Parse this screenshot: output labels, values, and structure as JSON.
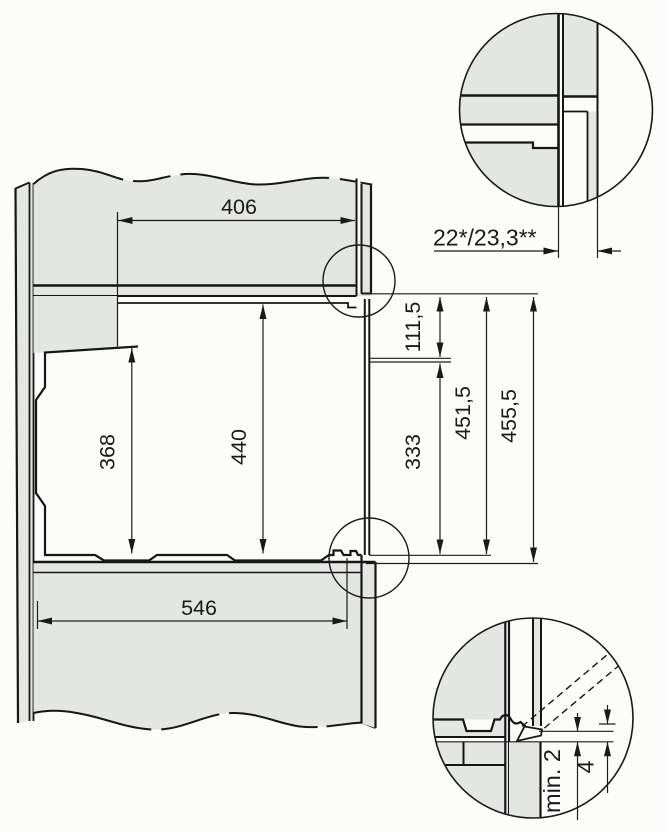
{
  "diagram": {
    "description": "Built-in appliance niche installation drawing, side section with two detail circles",
    "unit": "mm",
    "colors": {
      "panel_fill": "#e4e6e3",
      "line": "#1a1a1a",
      "background": "#fcfcfb"
    },
    "labels": {
      "top_niche_depth": "406",
      "rear_height": "368",
      "niche_height": "440",
      "bottom_depth": "546",
      "front_panel_offset": "22*/23,3**",
      "upper_front_height": "111,5",
      "lower_front_height": "333",
      "front_inner_height": "451,5",
      "front_total_height": "455,5",
      "bottom_gap": "min. 2",
      "door_clearance": "4"
    }
  }
}
